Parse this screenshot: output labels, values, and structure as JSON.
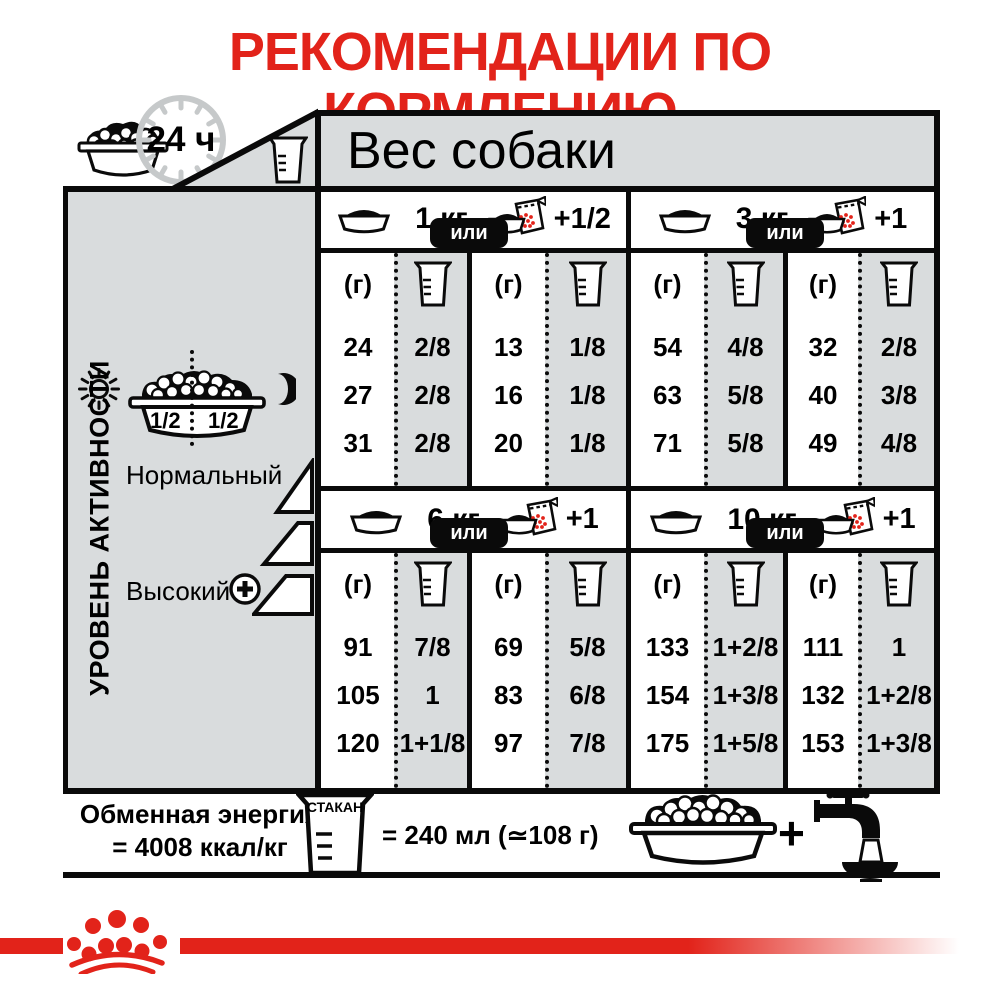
{
  "title": "РЕКОМЕНДАЦИИ ПО КОРМЛЕНИЮ",
  "colors": {
    "brand_red": "#e2231a",
    "panel_gray": "#d9dcdd"
  },
  "header": {
    "daily_label": "24 ч",
    "weight_title": "Вес собаки"
  },
  "sidebar": {
    "vertical_label": "УРОВЕНЬ АКТИВНОСТИ",
    "bowl_half_left": "1/2",
    "bowl_half_right": "1/2",
    "normal_label": "Нормальный",
    "high_label": "Высокий"
  },
  "table": {
    "or_label": "или",
    "grams_header": "(г)",
    "quadrants": [
      {
        "weight": "1 кг",
        "extra": "+1/2",
        "bowl": {
          "grams": [
            "24",
            "27",
            "31"
          ],
          "cups": [
            "2/8",
            "2/8",
            "2/8"
          ]
        },
        "pouch": {
          "grams": [
            "13",
            "16",
            "20"
          ],
          "cups": [
            "1/8",
            "1/8",
            "1/8"
          ]
        }
      },
      {
        "weight": "3 кг",
        "extra": "+1",
        "bowl": {
          "grams": [
            "54",
            "63",
            "71"
          ],
          "cups": [
            "4/8",
            "5/8",
            "5/8"
          ]
        },
        "pouch": {
          "grams": [
            "32",
            "40",
            "49"
          ],
          "cups": [
            "2/8",
            "3/8",
            "4/8"
          ]
        }
      },
      {
        "weight": "6 кг",
        "extra": "+1",
        "bowl": {
          "grams": [
            "91",
            "105",
            "120"
          ],
          "cups": [
            "7/8",
            "1",
            "1+1/8"
          ]
        },
        "pouch": {
          "grams": [
            "69",
            "83",
            "97"
          ],
          "cups": [
            "5/8",
            "6/8",
            "7/8"
          ]
        }
      },
      {
        "weight": "10 кг",
        "extra": "+1",
        "bowl": {
          "grams": [
            "133",
            "154",
            "175"
          ],
          "cups": [
            "1+2/8",
            "1+3/8",
            "1+5/8"
          ]
        },
        "pouch": {
          "grams": [
            "111",
            "132",
            "153"
          ],
          "cups": [
            "1",
            "1+2/8",
            "1+3/8"
          ]
        }
      }
    ]
  },
  "footer": {
    "energy_line1": "Обменная энергия",
    "energy_line2": "= 4008 ккал/кг",
    "cup_label": "СТАКАН",
    "cup_equiv": "= 240 мл (≃108 г)",
    "plus_sign": "+"
  }
}
